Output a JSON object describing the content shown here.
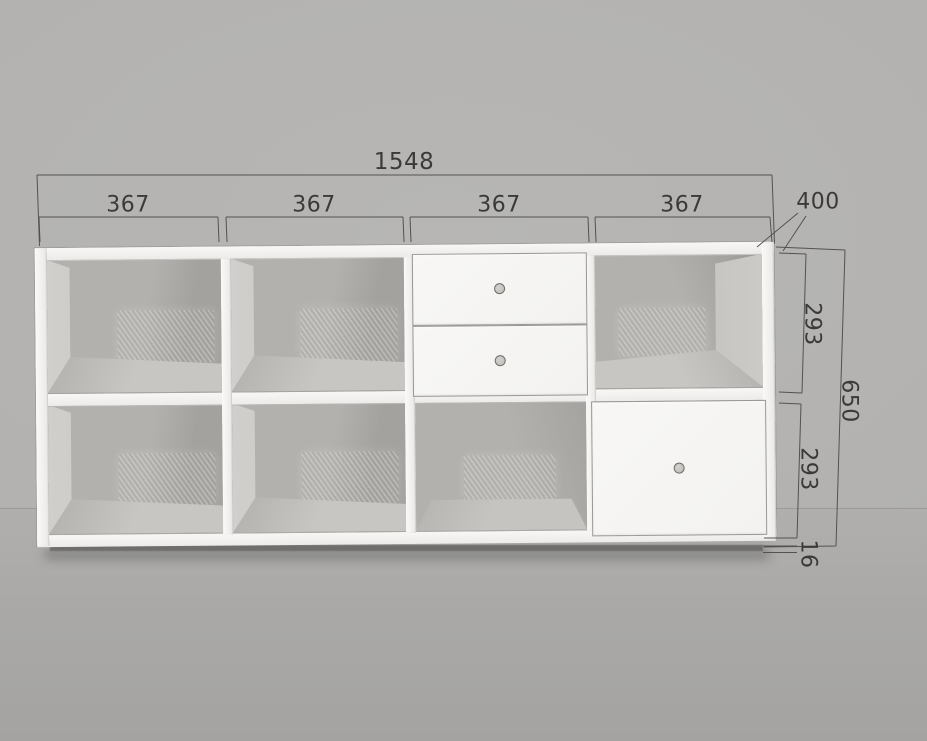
{
  "scene": {
    "type": "furniture-3d-dimension-drawing",
    "object": "sideboard shelf unit, 4 columns x 2 rows"
  },
  "dimensions": {
    "overall_width": "1548",
    "sections": [
      "367",
      "367",
      "367",
      "367"
    ],
    "depth": "400",
    "upper_compartment_height": "293",
    "overall_height": "650",
    "lower_compartment_height": "293",
    "panel_thickness": "16"
  },
  "cabinet": {
    "columns": 4,
    "rows": 2,
    "cells": [
      {
        "row": 1,
        "col": 1,
        "type": "open"
      },
      {
        "row": 1,
        "col": 2,
        "type": "open"
      },
      {
        "row": 1,
        "col": 3,
        "type": "drawers",
        "drawer_count": 2,
        "knobs": 2
      },
      {
        "row": 1,
        "col": 4,
        "type": "open"
      },
      {
        "row": 2,
        "col": 1,
        "type": "open"
      },
      {
        "row": 2,
        "col": 2,
        "type": "open"
      },
      {
        "row": 2,
        "col": 3,
        "type": "open"
      },
      {
        "row": 2,
        "col": 4,
        "type": "door",
        "knobs": 1
      }
    ]
  },
  "colors": {
    "wall": "#b5b4b2",
    "floor": "#abaaa8",
    "cabinet_body": "#f2f1ef",
    "front_panels": "#f7f6f4",
    "interior_back": "#b2b1ae",
    "interior_floor": "#c5c4c1",
    "knob": "#c7c6c3",
    "plinth_shadow": "#6f6e6c",
    "dimension_line": "#54524e",
    "dimension_text": "#3b3a37"
  }
}
